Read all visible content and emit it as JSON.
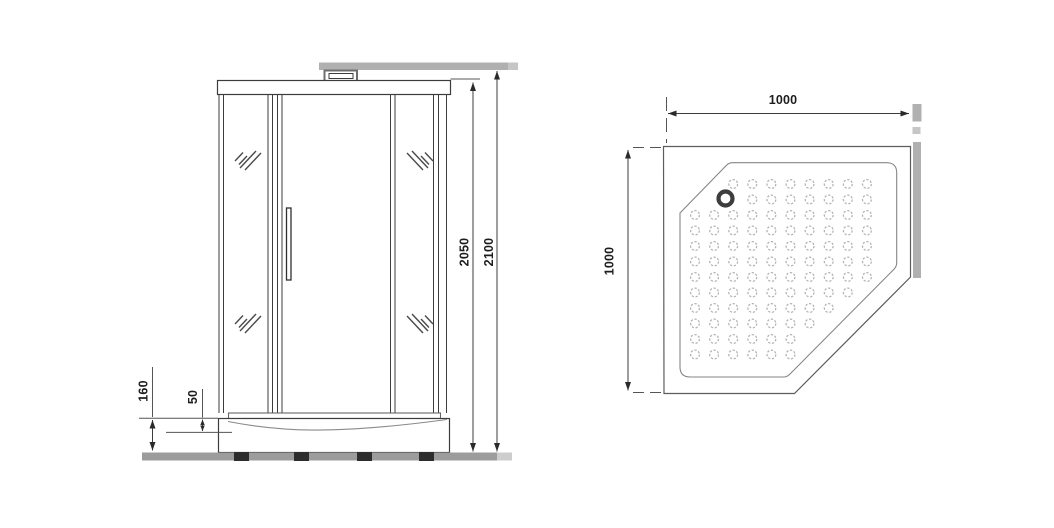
{
  "front_view": {
    "dim_cabin_height": "2050",
    "dim_overall_height": "2100",
    "dim_base_height": "160",
    "dim_tray_rim": "50"
  },
  "top_view": {
    "dim_width": "1000",
    "dim_depth": "1000"
  },
  "colors": {
    "line": "#3c3c3c",
    "wall_gray": "#b0b0b0",
    "wall_gray_light": "#c6c6c6",
    "ground_gray": "#9c9c9c",
    "ground_gray_light": "#cdcdcd",
    "feet_dark": "#2d2d2d",
    "dot_gray": "#b3b3b3",
    "arrow": "#2a2a2a"
  }
}
